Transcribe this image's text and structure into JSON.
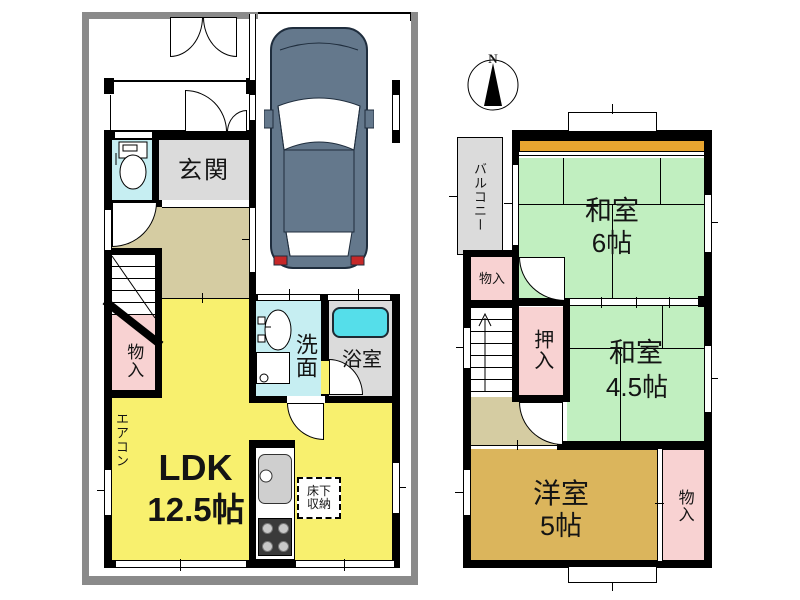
{
  "compass": {
    "north": "N"
  },
  "floor1": {
    "entrance": "玄関",
    "ldk_name": "LDK",
    "ldk_size": "12.5帖",
    "washroom": "洗面",
    "bath": "浴室",
    "storage": "物入",
    "underfloor_line1": "床下",
    "underfloor_line2": "収納",
    "aircon": "エアコン"
  },
  "floor2": {
    "balcony": "バルコニー",
    "storage_top": "物入",
    "jroom6_name": "和室",
    "jroom6_size": "6帖",
    "closet": "押入",
    "jroom45_name": "和室",
    "jroom45_size": "4.5帖",
    "wroom_name": "洋室",
    "wroom_size": "5帖",
    "storage_bottom": "物入"
  },
  "colors": {
    "ldk_yellow": "#F8F06E",
    "tatami_green": "#C1EFC0",
    "western_tan": "#DBB55C",
    "storage_pink": "#F8D2D2",
    "wet_cyan": "#C6EEF2",
    "tub_cyan": "#55DEEA",
    "room_gray": "#DBDBDB",
    "hall_beige": "#D5CCA2",
    "accent_orange": "#E8A530",
    "frame_gray": "#8A8A8A",
    "car_slate": "#64788C"
  }
}
